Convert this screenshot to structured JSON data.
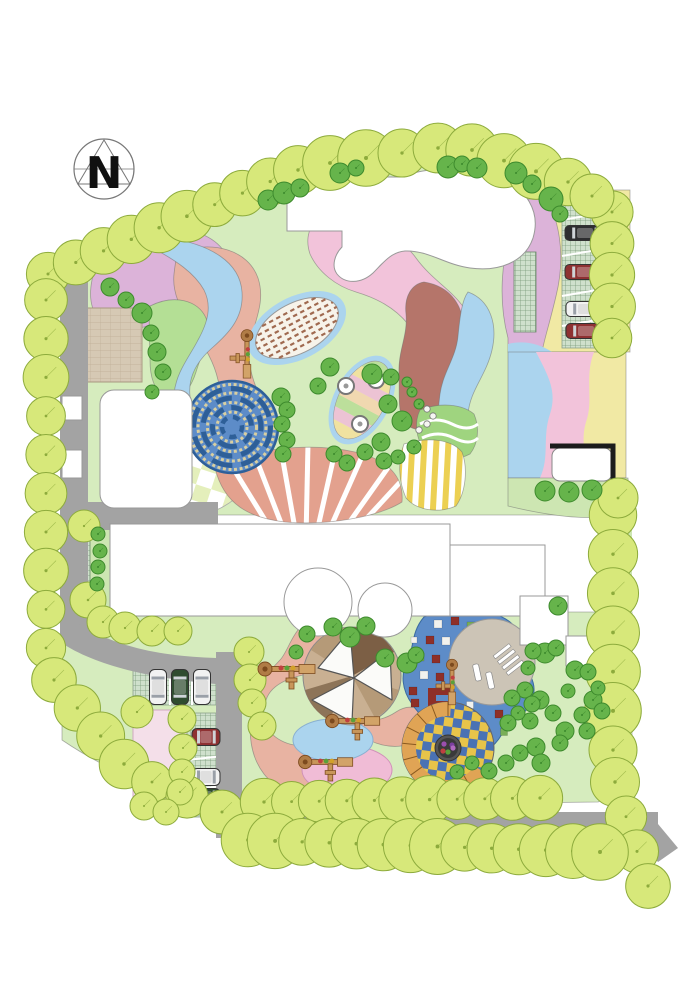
{
  "compass": {
    "label": "N"
  },
  "palette": {
    "lawn": "#d6ecbe",
    "lawn2": "#cde6b2",
    "road": "#a3a3a3",
    "building": "#ffffff",
    "outline": "#999999",
    "tree_yellow": "#d7e87a",
    "tree_yellow_edge": "#8dab3c",
    "tree_green": "#66b44b",
    "tree_green_edge": "#3d8a2d",
    "mauve": "#dcb3d9",
    "pink": "#f2c3da",
    "salmon": "#e8b3a2",
    "salmon2": "#e3a18e",
    "terracotta": "#b5756a",
    "blue_light": "#abd4ee",
    "blue_mid": "#5d8cc8",
    "maze_wall": "#2e5f98",
    "maze_path": "#d9cfa0",
    "yellow_pale": "#f1e9a4",
    "green_band": "#b4df95",
    "green_wave": "#9fd47f",
    "tan_paving": "#d6c9b4",
    "brick_line": "#bfae96",
    "sand": "#c9b092",
    "sand_dark": "#7c5f45",
    "sand_mid": "#b59a78",
    "checker_yellow": "#e8c44a",
    "checker_blue": "#4a72b4",
    "checker_pale": "#e4efbb",
    "stripes_yellow": "#ecd052",
    "steps_orange": "#e0a455",
    "steps_edge": "#8a5a20",
    "grid_bg": "#cfe0cc",
    "grid_line": "#7a9a7a",
    "car_white": "#f2f2f2",
    "car_black": "#2e2e30",
    "car_red": "#8e3132",
    "car_green": "#2f4c2f",
    "equip_tan": "#c8965a",
    "equip_dark": "#7c4a1e",
    "mosaic_red": "#8e2f28",
    "mosaic_white": "#f2f2ee",
    "mosaic_green": "#79ae58",
    "mosaic_yellow": "#d9b64a",
    "stripe_leaf": "#a06a50",
    "plaza_gray": "#ccc4b6",
    "pink_pale": "#f4dfe9",
    "leaf_y": "#f0e2a0",
    "leaf_p": "#ecc3d4",
    "leaf_g": "#bcdf9b",
    "leaf_t": "#f0d8b0"
  },
  "trees": {
    "chains": [
      {
        "from": [
          48,
          274
        ],
        "to": [
          298,
          170
        ],
        "count": 10,
        "r": 24
      },
      {
        "from": [
          330,
          163
        ],
        "to": [
          438,
          148
        ],
        "count": 4,
        "r": 26
      },
      {
        "from": [
          472,
          150
        ],
        "to": [
          568,
          182
        ],
        "count": 4,
        "r": 26
      },
      {
        "from": [
          612,
          212
        ],
        "to": [
          612,
          338
        ],
        "count": 5,
        "r": 22
      },
      {
        "from": [
          613,
          515
        ],
        "to": [
          613,
          750
        ],
        "count": 7,
        "r": 26
      },
      {
        "from": [
          615,
          782
        ],
        "to": [
          648,
          886
        ],
        "count": 4,
        "r": 23
      },
      {
        "from": [
          46,
          300
        ],
        "to": [
          46,
          648
        ],
        "count": 10,
        "r": 21
      },
      {
        "from": [
          54,
          680
        ],
        "to": [
          124,
          764
        ],
        "count": 4,
        "r": 23
      },
      {
        "from": [
          152,
          782
        ],
        "to": [
          222,
          812
        ],
        "count": 3,
        "r": 22
      },
      {
        "from": [
          264,
          802
        ],
        "to": [
          540,
          798
        ],
        "count": 11,
        "r": 22
      },
      {
        "from": [
          248,
          840
        ],
        "to": [
          600,
          852
        ],
        "count": 14,
        "r": 26
      }
    ],
    "yellow_singles": [
      [
        592,
        196,
        22
      ],
      [
        84,
        526,
        16
      ],
      [
        88,
        600,
        18
      ],
      [
        103,
        622,
        16
      ],
      [
        125,
        628,
        16
      ],
      [
        152,
        631,
        15
      ],
      [
        178,
        631,
        14
      ],
      [
        618,
        498,
        20
      ],
      [
        137,
        712,
        16
      ],
      [
        182,
        719,
        14
      ],
      [
        183,
        748,
        14
      ],
      [
        182,
        772,
        13
      ],
      [
        180,
        792,
        13
      ],
      [
        144,
        806,
        14
      ],
      [
        166,
        812,
        13
      ],
      [
        249,
        652,
        15
      ],
      [
        250,
        680,
        16
      ],
      [
        252,
        703,
        14
      ],
      [
        262,
        726,
        14
      ]
    ],
    "green_singles": [
      [
        268,
        200,
        10
      ],
      [
        284,
        193,
        11
      ],
      [
        300,
        188,
        9
      ],
      [
        340,
        173,
        10
      ],
      [
        356,
        168,
        8
      ],
      [
        448,
        167,
        11
      ],
      [
        462,
        164,
        8
      ],
      [
        477,
        168,
        10
      ],
      [
        516,
        173,
        11
      ],
      [
        532,
        184,
        9
      ],
      [
        551,
        199,
        12
      ],
      [
        560,
        214,
        8
      ],
      [
        110,
        287,
        9
      ],
      [
        126,
        300,
        8
      ],
      [
        142,
        313,
        10
      ],
      [
        151,
        333,
        8
      ],
      [
        157,
        352,
        9
      ],
      [
        163,
        372,
        8
      ],
      [
        152,
        392,
        7
      ],
      [
        281,
        397,
        9
      ],
      [
        287,
        410,
        8
      ],
      [
        282,
        424,
        8
      ],
      [
        287,
        440,
        8
      ],
      [
        283,
        454,
        8
      ],
      [
        318,
        386,
        8
      ],
      [
        330,
        367,
        9
      ],
      [
        372,
        374,
        10
      ],
      [
        391,
        377,
        8
      ],
      [
        388,
        404,
        9
      ],
      [
        402,
        421,
        10
      ],
      [
        381,
        442,
        9
      ],
      [
        365,
        452,
        8
      ],
      [
        334,
        454,
        8
      ],
      [
        347,
        463,
        8
      ],
      [
        384,
        461,
        8
      ],
      [
        398,
        457,
        7
      ],
      [
        414,
        447,
        7
      ],
      [
        412,
        392,
        5
      ],
      [
        419,
        404,
        5
      ],
      [
        407,
        382,
        5
      ],
      [
        545,
        491,
        10
      ],
      [
        569,
        492,
        10
      ],
      [
        592,
        490,
        10
      ],
      [
        98,
        534,
        7
      ],
      [
        100,
        551,
        7
      ],
      [
        98,
        567,
        7
      ],
      [
        97,
        584,
        7
      ],
      [
        333,
        627,
        9
      ],
      [
        350,
        637,
        10
      ],
      [
        366,
        626,
        9
      ],
      [
        385,
        658,
        9
      ],
      [
        407,
        663,
        10
      ],
      [
        416,
        655,
        8
      ],
      [
        307,
        634,
        8
      ],
      [
        296,
        652,
        7
      ],
      [
        558,
        606,
        9
      ],
      [
        545,
        653,
        10
      ],
      [
        533,
        651,
        8
      ],
      [
        556,
        648,
        8
      ],
      [
        575,
        670,
        9
      ],
      [
        588,
        672,
        8
      ],
      [
        525,
        690,
        8
      ],
      [
        540,
        700,
        9
      ],
      [
        532,
        704,
        8
      ],
      [
        593,
        700,
        9
      ],
      [
        602,
        711,
        8
      ],
      [
        582,
        715,
        8
      ],
      [
        565,
        731,
        9
      ],
      [
        587,
        731,
        8
      ],
      [
        530,
        721,
        8
      ],
      [
        536,
        747,
        9
      ],
      [
        568,
        691,
        7
      ],
      [
        598,
        688,
        7
      ],
      [
        528,
        668,
        7
      ],
      [
        512,
        698,
        8
      ],
      [
        518,
        713,
        7
      ],
      [
        508,
        723,
        8
      ],
      [
        553,
        713,
        8
      ],
      [
        560,
        743,
        8
      ],
      [
        541,
        763,
        9
      ],
      [
        520,
        753,
        8
      ],
      [
        506,
        763,
        8
      ],
      [
        489,
        771,
        8
      ],
      [
        472,
        763,
        7
      ],
      [
        457,
        772,
        7
      ]
    ]
  },
  "cars": [
    [
      585,
      233,
      40,
      15,
      "black"
    ],
    [
      585,
      272,
      40,
      15,
      "red"
    ],
    [
      586,
      309,
      40,
      15,
      "white"
    ],
    [
      586,
      331,
      40,
      15,
      "red"
    ],
    [
      158,
      687,
      17,
      35,
      "white"
    ],
    [
      180,
      687,
      17,
      35,
      "green"
    ],
    [
      202,
      687,
      17,
      35,
      "white"
    ],
    [
      206,
      737,
      28,
      17,
      "red"
    ],
    [
      206,
      777,
      28,
      17,
      "white"
    ],
    [
      206,
      797,
      28,
      17,
      "green"
    ]
  ],
  "equipment": [
    [
      247,
      356,
      90,
      0.85
    ],
    [
      289,
      669,
      0,
      1
    ],
    [
      355,
      721,
      0,
      0.95
    ],
    [
      328,
      762,
      0,
      0.95
    ],
    [
      452,
      684,
      90,
      0.8
    ]
  ],
  "mosaic": [
    [
      438,
      624,
      8,
      "w"
    ],
    [
      455,
      621,
      8,
      "r"
    ],
    [
      471,
      626,
      8,
      "g"
    ],
    [
      430,
      640,
      8,
      "r"
    ],
    [
      446,
      641,
      8,
      "w"
    ],
    [
      462,
      644,
      8,
      "r"
    ],
    [
      477,
      641,
      7,
      "w"
    ],
    [
      420,
      657,
      8,
      "g"
    ],
    [
      436,
      659,
      8,
      "r"
    ],
    [
      452,
      661,
      7,
      "w"
    ],
    [
      424,
      675,
      8,
      "w"
    ],
    [
      440,
      677,
      8,
      "r"
    ],
    [
      413,
      691,
      8,
      "r"
    ],
    [
      415,
      703,
      8,
      "r"
    ],
    [
      486,
      699,
      7,
      "g"
    ],
    [
      470,
      705,
      7,
      "w"
    ],
    [
      499,
      714,
      8,
      "r"
    ],
    [
      456,
      717,
      7,
      "g"
    ],
    [
      428,
      721,
      8,
      "w"
    ],
    [
      444,
      729,
      8,
      "r"
    ],
    [
      507,
      687,
      7,
      "w"
    ],
    [
      491,
      679,
      7,
      "r"
    ],
    [
      476,
      667,
      7,
      "g"
    ],
    [
      466,
      632,
      6,
      "y"
    ],
    [
      485,
      652,
      6,
      "y"
    ],
    [
      414,
      640,
      6,
      "w"
    ],
    [
      504,
      732,
      7,
      "g"
    ],
    [
      489,
      741,
      7,
      "w"
    ],
    [
      474,
      748,
      7,
      "r"
    ]
  ],
  "stones": [
    [
      413,
      394
    ],
    [
      420,
      402
    ],
    [
      427,
      409
    ],
    [
      433,
      416
    ],
    [
      427,
      424
    ],
    [
      419,
      430
    ]
  ],
  "flowers": [
    [
      444,
      744,
      "#9a4fae"
    ],
    [
      452,
      745,
      "#7a3f9e"
    ],
    [
      448,
      752,
      "#5aa03a"
    ],
    [
      443,
      751,
      "#c04040"
    ],
    [
      453,
      748,
      "#b06ac0"
    ]
  ]
}
